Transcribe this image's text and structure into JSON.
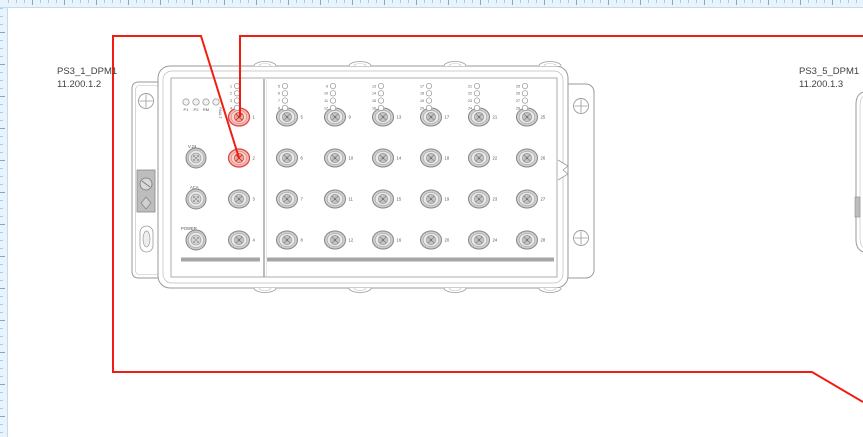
{
  "canvas": {
    "background": "#ffffff"
  },
  "rulers": {
    "band": "#e9f3fb",
    "border": "#bfdcf0",
    "tick_minor": "#a9c9e4",
    "tick_major": "#7fa8cd"
  },
  "colors": {
    "connection": "#f21d12",
    "device_stroke": "#9a9a9a",
    "device_stroke_light": "#bdbdbd",
    "port_ring": "#868686",
    "port_fill": "#cdcdcd",
    "port_mid": "#e9e9e9",
    "port_inner": "#c4c4c4",
    "pin_color": "#808080",
    "highlight_fill": "#f5b9b4",
    "highlight_mid": "#f8d2ce",
    "highlight_inner": "#efa49d",
    "highlight_stroke": "#d9453a",
    "label_text": "#3f3f3f",
    "small_text": "#555555",
    "bar_fill": "#a6a6a6",
    "metal_fill": "#bdbdbd"
  },
  "devices": [
    {
      "name": "PS3_1_DPM1",
      "ip": "11.200.1.2",
      "status_leds": [
        "P1",
        "P2",
        "RM",
        "FAULT"
      ],
      "connectors": [
        "V.24",
        "ACA",
        "POWER"
      ],
      "port_count": 28,
      "port_labels": [
        "1",
        "2",
        "3",
        "4",
        "5",
        "6",
        "7",
        "8",
        "9",
        "10",
        "11",
        "12",
        "13",
        "14",
        "15",
        "16",
        "17",
        "18",
        "19",
        "20",
        "21",
        "22",
        "23",
        "24",
        "25",
        "26",
        "27",
        "28"
      ],
      "highlighted_ports": [
        1,
        2
      ]
    },
    {
      "name": "PS3_5_DPM1",
      "ip": "11.200.1.3",
      "partial": true
    }
  ],
  "connections": [
    {
      "name": "connection-port-1",
      "from": "PS3_1_DPM1 port 1",
      "points": [
        [
          240,
          117
        ],
        [
          240,
          36
        ],
        [
          863,
          36
        ]
      ]
    },
    {
      "name": "connection-port-2",
      "from": "PS3_1_DPM1 port 2",
      "points": [
        [
          239,
          158
        ],
        [
          201,
          36
        ],
        [
          113,
          36
        ],
        [
          113,
          372
        ],
        [
          812,
          372
        ],
        [
          863,
          402
        ]
      ]
    }
  ]
}
